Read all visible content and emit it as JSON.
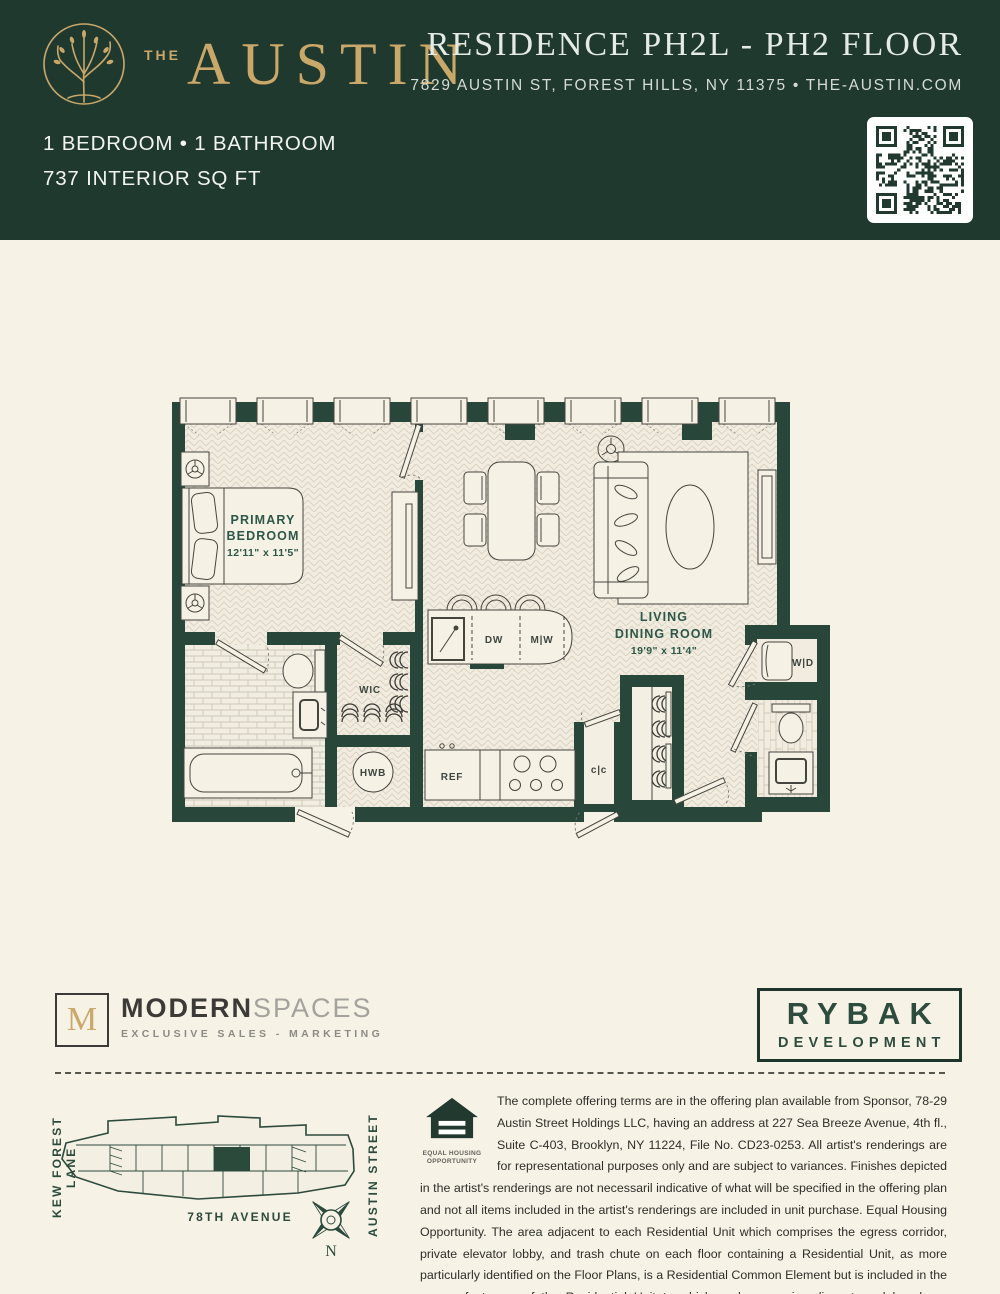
{
  "header": {
    "brand_the": "THE",
    "brand_name": "AUSTIN",
    "title": "RESIDENCE PH2L - PH2 FLOOR",
    "address": "7829 AUSTIN ST, FOREST HILLS, NY 11375 • THE-AUSTIN.COM",
    "bed_bath": "1 BEDROOM  •  1 BATHROOM",
    "sqft": "737 INTERIOR SQ FT"
  },
  "plan": {
    "primary_bedroom": {
      "line1": "PRIMARY",
      "line2": "BEDROOM",
      "dims": "12'11\" x 11'5\""
    },
    "living_dining": {
      "line1": "LIVING",
      "line2": "DINING ROOM",
      "dims": "19'9\" x 11'4\""
    },
    "wic": "WIC",
    "hwb": "HWB",
    "dw": "DW",
    "mw": "M|W",
    "ref": "REF",
    "cc": "c|c",
    "wd": "W|D"
  },
  "footer": {
    "modern_m": "M",
    "modern": "MODERN",
    "spaces": "SPACES",
    "tagline": "EXCLUSIVE SALES - MARKETING",
    "rybak1": "RYBAK",
    "rybak2": "DEVELOPMENT",
    "map": {
      "left": "KEW FOREST LANE",
      "right": "AUSTIN STREET",
      "bottom": "78TH AVENUE",
      "north": "N"
    },
    "eho1": "EQUAL HOUSING",
    "eho2": "OPPORTUNITY",
    "disclaimer": "The complete offering terms are in the offering plan available from Sponsor, 78-29 Austin Street Holdings LLC, having an address at 227 Sea Breeze Avenue, 4th fl., Suite C-403, Brooklyn, NY 11224, File No. CD23-0253. All artist's renderings are for representational purposes only and are subject to variances. Finishes depicted in the artist's renderings are not necessaril indicative of what will be specified in the offering plan and not all items included in the artist's renderings are included in unit purchase. Equal Housing Opportunity. The area adjacent to each Residential Unit which comprises the egress corridor, private elevator lobby, and trash chute on each floor containing a Residential Unit, as more particularly identified on the Floor Plans, is a Residential Common Element but is included in the square foot area of the Residential Unit to which such space is adjacent, and has been measured to the centerline of the partitions defining such space."
  },
  "colors": {
    "header_bg": "#20392e",
    "gold": "#c9a86a",
    "cream": "#f7f2e6",
    "wall_green": "#28473a",
    "label_green": "#2d5748"
  }
}
